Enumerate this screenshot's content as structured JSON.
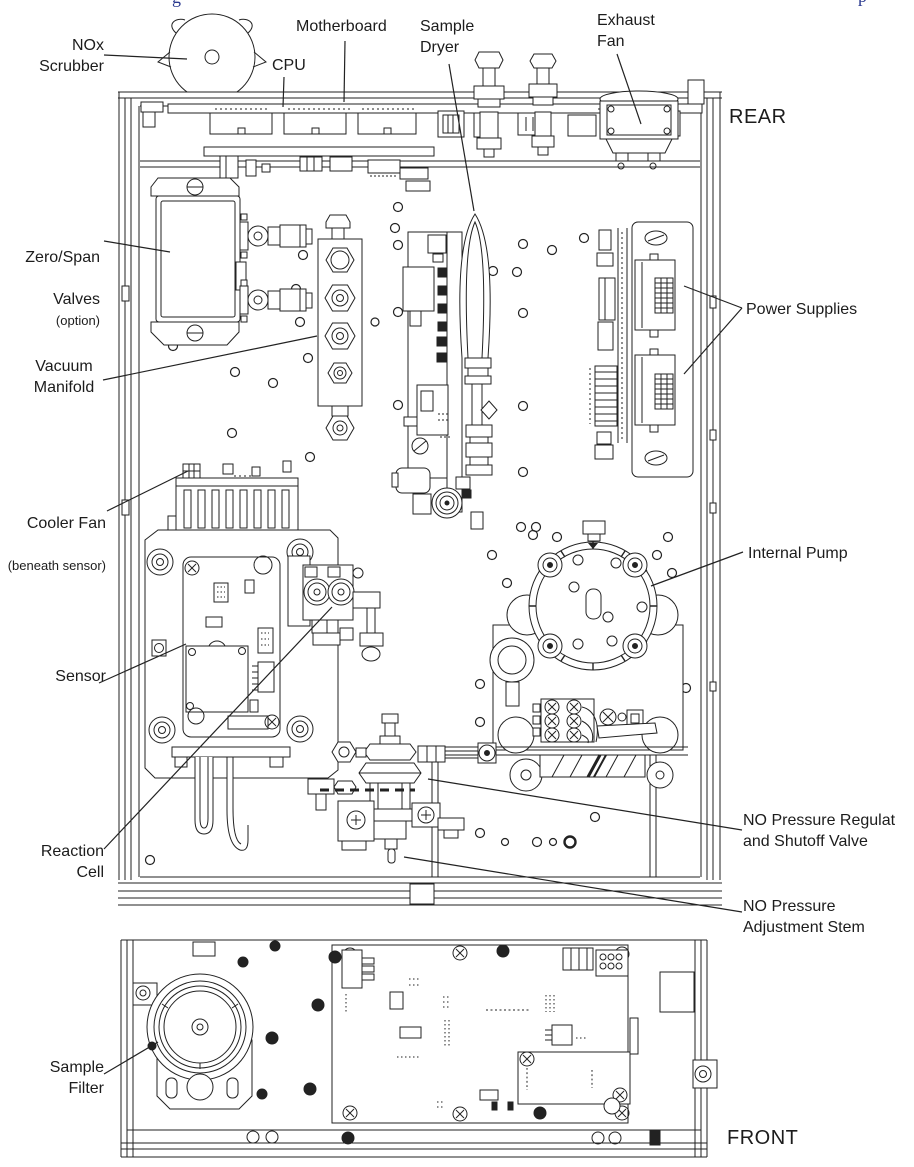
{
  "figure": {
    "caption_fragment_left": "g",
    "caption_fragment_right": "p"
  },
  "orientation_labels": {
    "rear": "REAR",
    "front": "FRONT"
  },
  "component_labels": {
    "nox_scrubber": "NOx\nScrubber",
    "cpu": "CPU",
    "motherboard": "Motherboard",
    "sample_dryer": "Sample\nDryer",
    "exhaust_fan": "Exhaust\nFan",
    "zero_span_line1": "Zero/Span",
    "zero_span_line2": "Valves",
    "zero_span_option": "(option)",
    "vacuum_manifold": "Vacuum\nManifold",
    "power_supplies": "Power Supplies",
    "cooler_fan_line1": "Cooler Fan",
    "cooler_fan_line2": "(beneath sensor)",
    "sensor": "Sensor",
    "reaction_cell": "Reaction\nCell",
    "internal_pump": "Internal Pump",
    "no_pressure_regulator": "NO Pressure Regulat\nand Shutoff Valve",
    "no_pressure_stem": "NO Pressure\nAdjustment Stem",
    "sample_filter": "Sample\nFilter"
  },
  "colors": {
    "line": "#222222",
    "caption": "#2b3a8f",
    "background": "#ffffff"
  }
}
